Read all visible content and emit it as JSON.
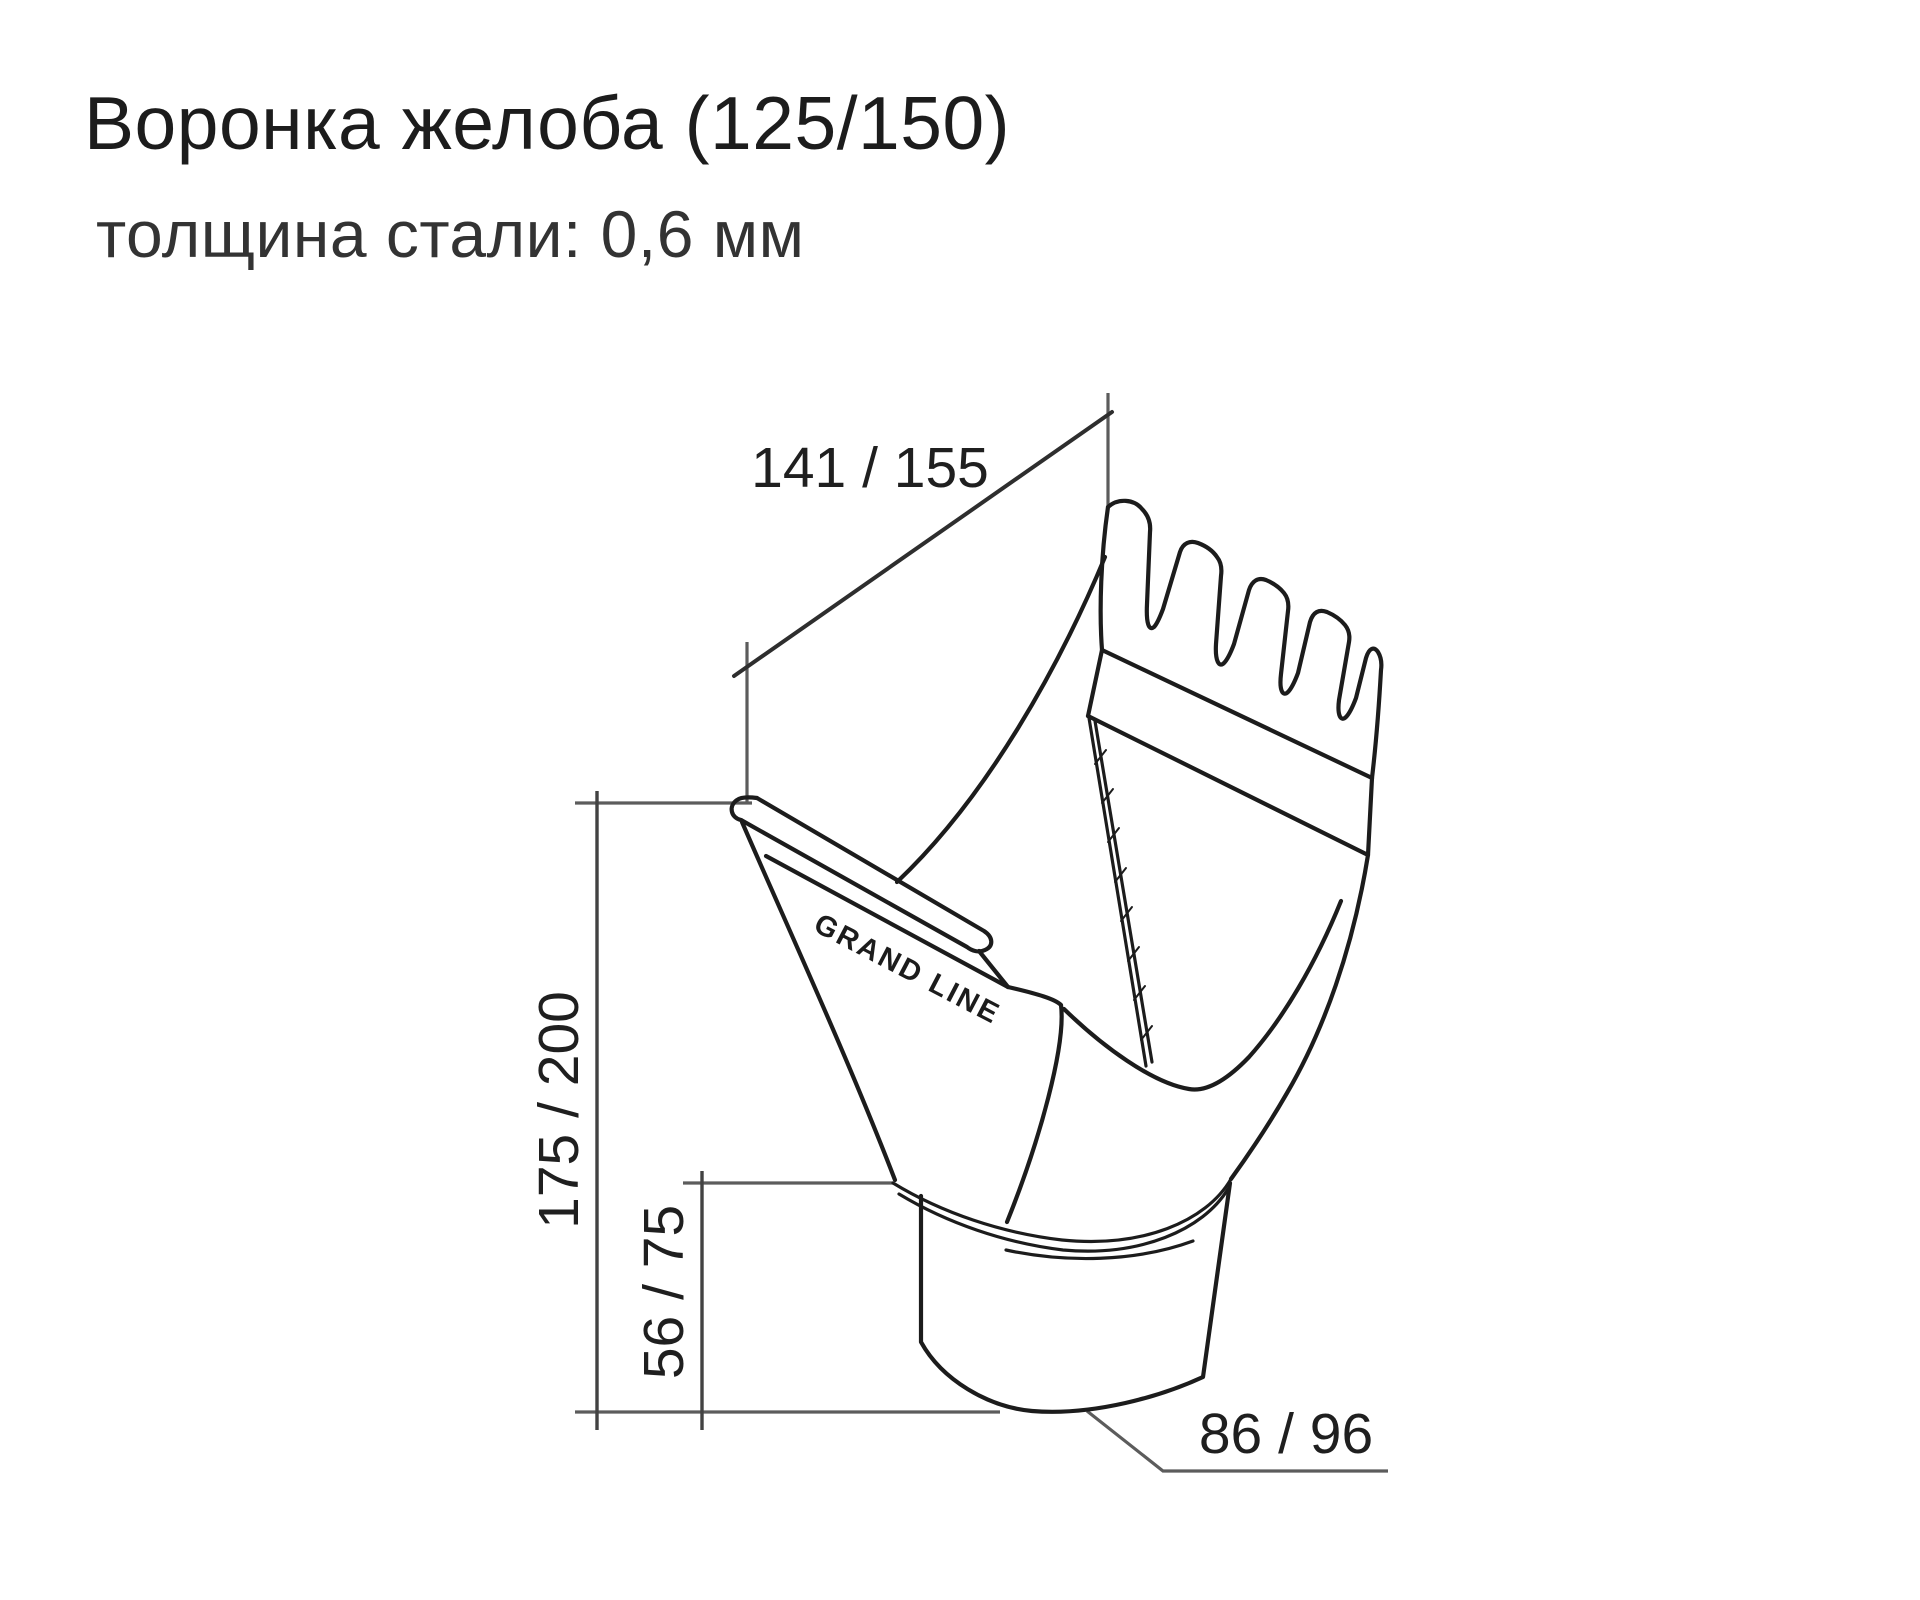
{
  "header": {
    "title": "Воронка желоба (125/150)",
    "subtitle": "толщина стали: 0,6 мм"
  },
  "drawing": {
    "brand_label": "GRAND LINE",
    "dimensions": {
      "gutter_width": "141 / 155",
      "total_height": "175 / 200",
      "spout_height": "56 / 75",
      "outlet_diameter": "86 / 96"
    },
    "colors": {
      "outline": "#1c1c1c",
      "dimension_line": "#424242",
      "extension_line": "#5c5c5c",
      "label_text": "#1f1f1f",
      "background": "#ffffff"
    }
  }
}
